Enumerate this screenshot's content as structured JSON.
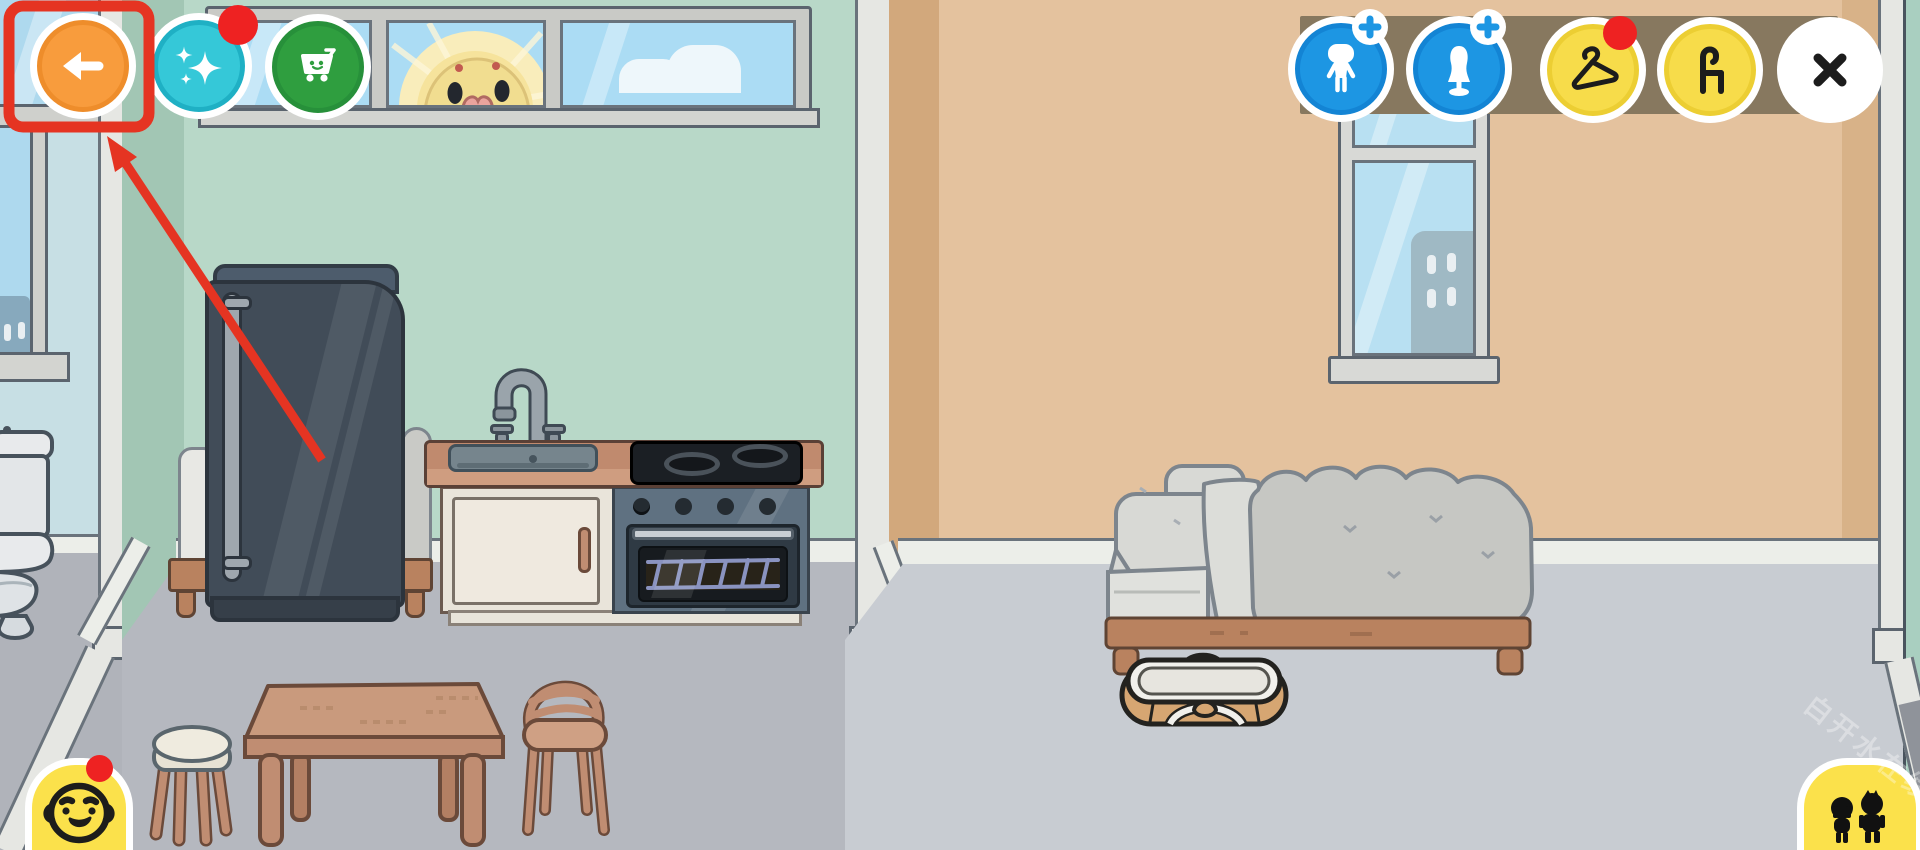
{
  "ui": {
    "top_left_buttons": [
      {
        "id": "back",
        "icon": "arrow-left-icon",
        "bg": "#F89C3D",
        "ring": "#EE8D2B",
        "badge": null,
        "highlighted": true
      },
      {
        "id": "magic",
        "icon": "sparkles-icon",
        "bg": "#35C8D8",
        "ring": "#1FB0C4",
        "badge": "red-dot"
      },
      {
        "id": "shop",
        "icon": "cart-smile-icon",
        "bg": "#2F9E3F",
        "ring": "#27903A",
        "badge": null
      }
    ],
    "top_right_toolbar": {
      "bar_color": "#87785F",
      "buttons": [
        {
          "id": "add-character",
          "icon": "character-silhouette-icon",
          "bg": "#1D96E3",
          "badge": "plus-badge"
        },
        {
          "id": "add-mannequin",
          "icon": "mannequin-icon",
          "bg": "#1D96E3",
          "badge": "plus-badge"
        },
        {
          "id": "clothes",
          "icon": "hanger-icon",
          "bg": "#F7DC4A",
          "badge": "red-dot"
        },
        {
          "id": "furniture",
          "icon": "chair-icon",
          "bg": "#F7DC4A",
          "badge": null
        },
        {
          "id": "close",
          "icon": "x-icon",
          "bg": "#FFFFFF",
          "badge": null
        }
      ]
    },
    "bottom_left_tab": {
      "id": "characters",
      "icon": "baby-face-icon",
      "bg": "#FBE14B",
      "badge": "red-dot"
    },
    "bottom_right_tab": {
      "id": "people",
      "icon": "two-characters-icon",
      "bg": "#FBE14B",
      "badge": null
    },
    "watermark": "白开水在线"
  },
  "annotation": {
    "type": "tutorial-highlight",
    "target": "back-button",
    "box_color": "#E53422",
    "arrow_color": "#E53422"
  },
  "scene": {
    "bathroom": {
      "wall_color": "#C7DFE4",
      "floor_color": "#B0B3BA",
      "items": [
        "city-window",
        "toilet"
      ]
    },
    "kitchen": {
      "wall_color": "#B8D8C8",
      "floor_color": "#B5B8BF",
      "items": [
        "three-pane-window",
        "sun-duck",
        "cloud",
        "fridge",
        "sink-counter",
        "faucet",
        "stove",
        "oven",
        "hidden-bed",
        "dining-table",
        "stool",
        "chair"
      ]
    },
    "bedroom": {
      "wall_color": "#E4C29E",
      "floor_color": "#C8CCD2",
      "items": [
        "city-window",
        "double-bed",
        "baby-bassinet"
      ]
    },
    "trim_color": "#E6E7E3"
  }
}
